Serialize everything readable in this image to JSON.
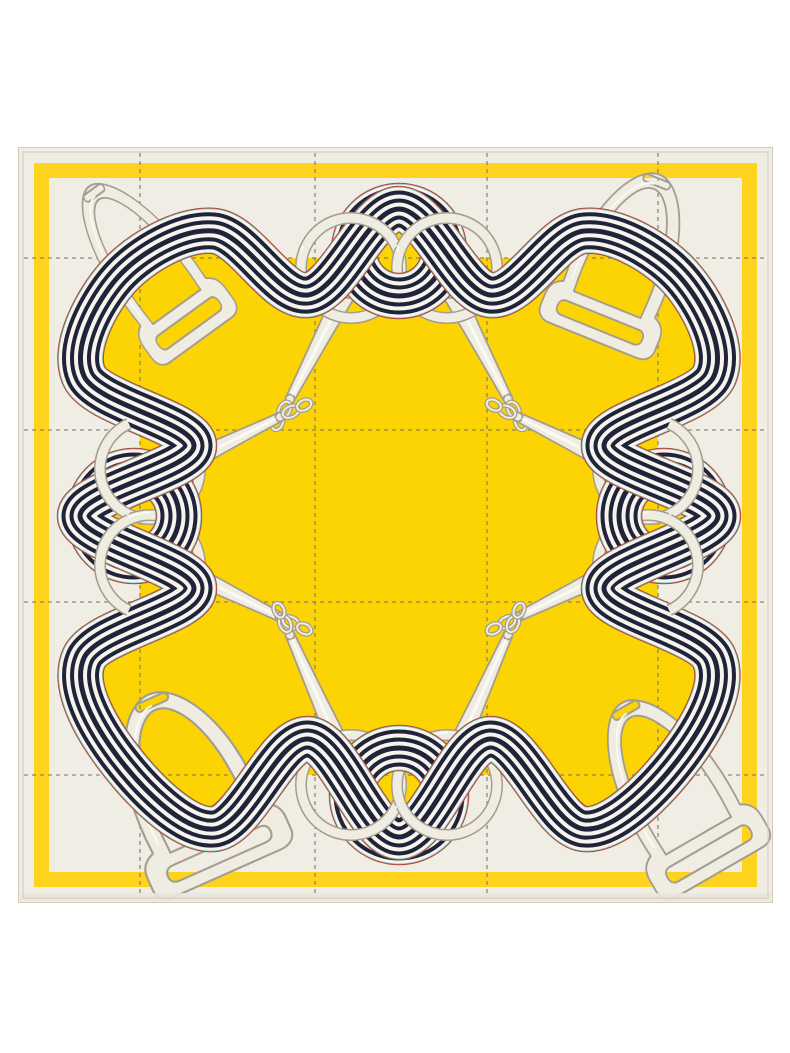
{
  "meta": {
    "alt_text": "Product photograph of a square silk twill scarf laid flat on a white background. The scarf has an off-white border with a dashed windowpane check, a thin golden-yellow frame stripe near the hem, and a large golden-yellow center field. A navy-and-white striped ribbon weaves in waves around the field, tied in knots at the middle of each side, threading through pale equestrian stirrups in the corners and through pairs of snaffle-bit rings whose cheek shanks and small chain links point into the yellow center."
  },
  "colors": {
    "photo_background": "#ffffff",
    "scarf_base": "#f0ede4",
    "field_yellow": "#fcd303",
    "frame_stripe_yellow": "#fdd31d",
    "ribbon_navy": "#20243a",
    "ribbon_white": "#f6f4ec",
    "fringe_red": "#b5443c",
    "fringe_teal": "#7cc4b6",
    "hardware_fill": "#efece1",
    "hardware_outline": "#a59e90",
    "hardware_highlight": "#fcfbf6",
    "grid_dash": "#7e7769",
    "hem_line": "#cfcaba",
    "hem_band": "#e9e6db"
  },
  "scarf": {
    "shape": "square",
    "style": "equestrian silk scarf print",
    "pattern": "dashed windowpane check with wavy striped-ribbon frame",
    "motifs": {
      "stirrups": 4,
      "bit_rings": 8,
      "bit_shanks": 8,
      "chain_link_pairs": 8,
      "ribbon_knots": 4,
      "ribbon_stripe_count": 5
    }
  }
}
